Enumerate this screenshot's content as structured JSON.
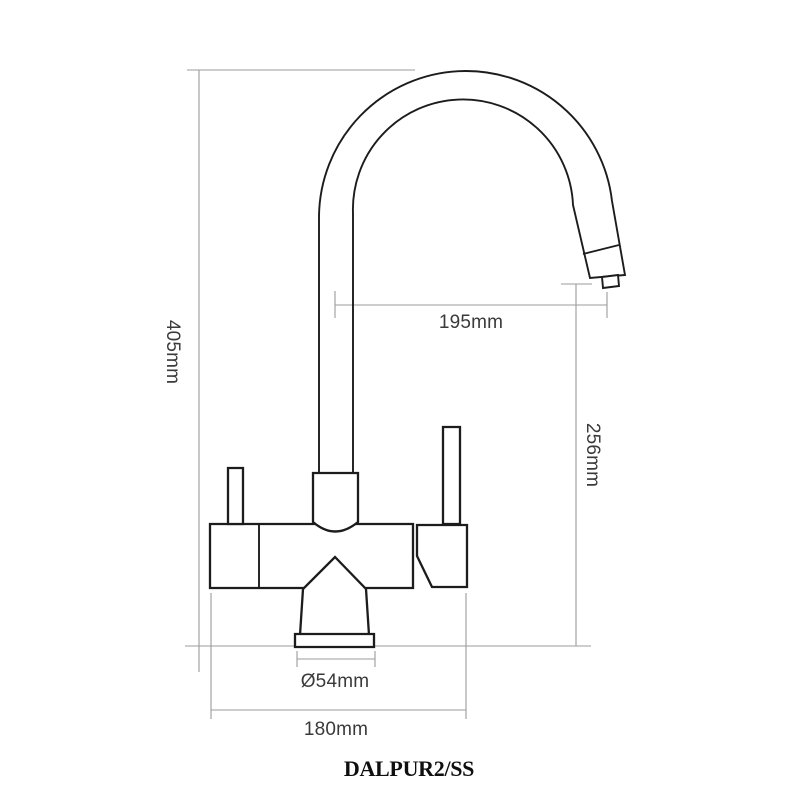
{
  "drawing": {
    "type": "technical-drawing",
    "subject": "kitchen mixer tap — side elevation with dimensions",
    "product_code": "DALPUR2/SS",
    "line_color": "#1c1c1c",
    "dimension_line_color": "#9b9b9b",
    "label_color": "#3a3a3a",
    "dimensions": {
      "overall_height": "405mm",
      "spout_reach": "195mm",
      "outlet_height": "256mm",
      "base_diameter": "Ø54mm",
      "overall_width": "180mm"
    }
  }
}
